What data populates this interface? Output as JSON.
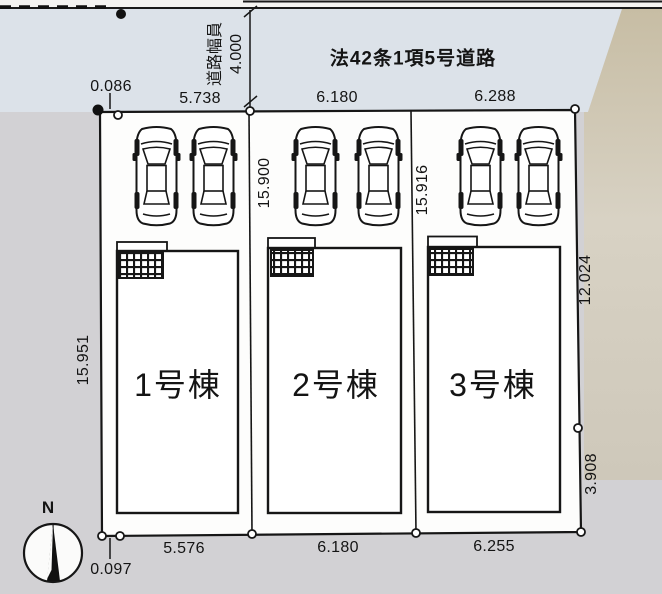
{
  "plan": {
    "road": {
      "name": "法42条1項5号道路",
      "width_label": "道路幅員",
      "width_value": "4.000"
    },
    "compass": {
      "north_label": "N"
    },
    "offsets": {
      "top": "0.086",
      "bottom": "0.097"
    },
    "lots": [
      {
        "label": "1号棟",
        "frontage_top": "5.738",
        "frontage_bottom": "5.576",
        "depth_left": "15.951"
      },
      {
        "label": "2号棟",
        "frontage_top": "6.180",
        "frontage_bottom": "6.180",
        "depth_left": "15.900"
      },
      {
        "label": "3号棟",
        "frontage_top": "6.288",
        "frontage_bottom": "6.255",
        "depth_left": "15.916",
        "depth_right_upper": "12.024",
        "depth_right_lower": "3.908"
      }
    ],
    "colors": {
      "road_fill": "#dce2e9",
      "bank_fill": "#cbc2ac",
      "ground_fill": "#d2d1d4",
      "parcel_fill": "#fdfdfc",
      "line": "#161616"
    }
  }
}
